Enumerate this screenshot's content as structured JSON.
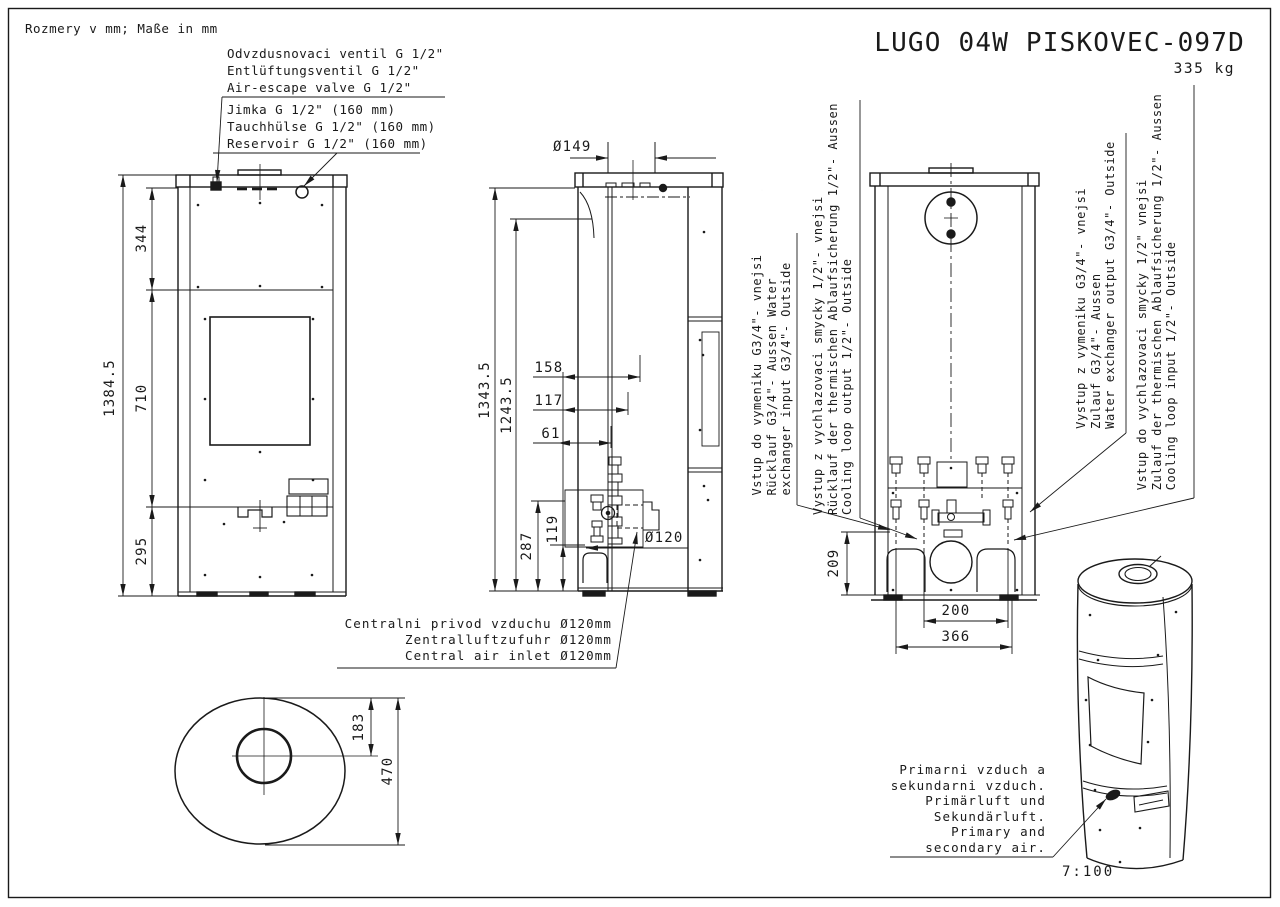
{
  "drawing": {
    "units_note": "Rozmery v mm; Maße in mm",
    "title": "LUGO 04W PISKOVEC-097D",
    "weight": "335 kg",
    "scale_note": "7:100"
  },
  "callouts": {
    "air_escape_valve": {
      "cs": "Odvzdusnovaci ventil G 1/2\"",
      "de": "Entlüftungsventil G 1/2\"",
      "en": "Air-escape valve G 1/2\""
    },
    "reservoir": {
      "cs": "Jimka G 1/2\" (160 mm)",
      "de": "Tauchhülse G 1/2\" (160 mm)",
      "en": "Reservoir G 1/2\" (160 mm)"
    },
    "water_exchanger_input": {
      "l1": "Vstup do vymeniku G3/4\"- vnejsi",
      "l2": "Rücklauf G3/4\"- Aussen Water",
      "l3": "exchanger input G3/4\"- Outside"
    },
    "cooling_loop_output": {
      "l1": "Vystup z vychlazovaci smycky 1/2\"- vnejsi",
      "l2": "Rücklauf der thermischen Ablaufsicherung 1/2\"- Aussen",
      "l3": "Cooling loop output 1/2\"- Outside"
    },
    "water_exchanger_output": {
      "l1": "Vystup z vymeniku G3/4\"- vnejsi",
      "l2": "Zulauf G3/4\"- Aussen",
      "l3": "Water exchanger output G3/4\"- Outside"
    },
    "cooling_loop_input": {
      "l1": "Vstup do vychlazovaci smycky 1/2\" vnejsi",
      "l2": "Zulauf der thermischen Ablaufsicherung 1/2\"- Aussen",
      "l3": "Cooling loop input 1/2\"- Outside"
    },
    "central_air_inlet": {
      "cs": "Centralni privod vzduchu Ø120mm",
      "de": "Zentralluftzufuhr Ø120mm",
      "en": "Central air inlet Ø120mm"
    },
    "primary_secondary_air": {
      "l1": "Primarni vzduch a",
      "l2": "sekundarni vzduch.",
      "l3": "Primärluft und",
      "l4": "Sekundärluft.",
      "l5": "Primary and",
      "l6": "secondary air."
    }
  },
  "dimensions": {
    "front_total_height": "1384.5",
    "front_top_section": "344",
    "front_window_section": "710",
    "front_bottom_section": "295",
    "flue_diameter": "Ø149",
    "side_height_flue": "1343.5",
    "side_height_shoulder": "1243.5",
    "side_158": "158",
    "side_117": "117",
    "side_61": "61",
    "side_287": "287",
    "side_119": "119",
    "air_inlet_diameter": "Ø120",
    "rear_209": "209",
    "rear_200": "200",
    "rear_366": "366",
    "bottom_183": "183",
    "bottom_470": "470"
  }
}
